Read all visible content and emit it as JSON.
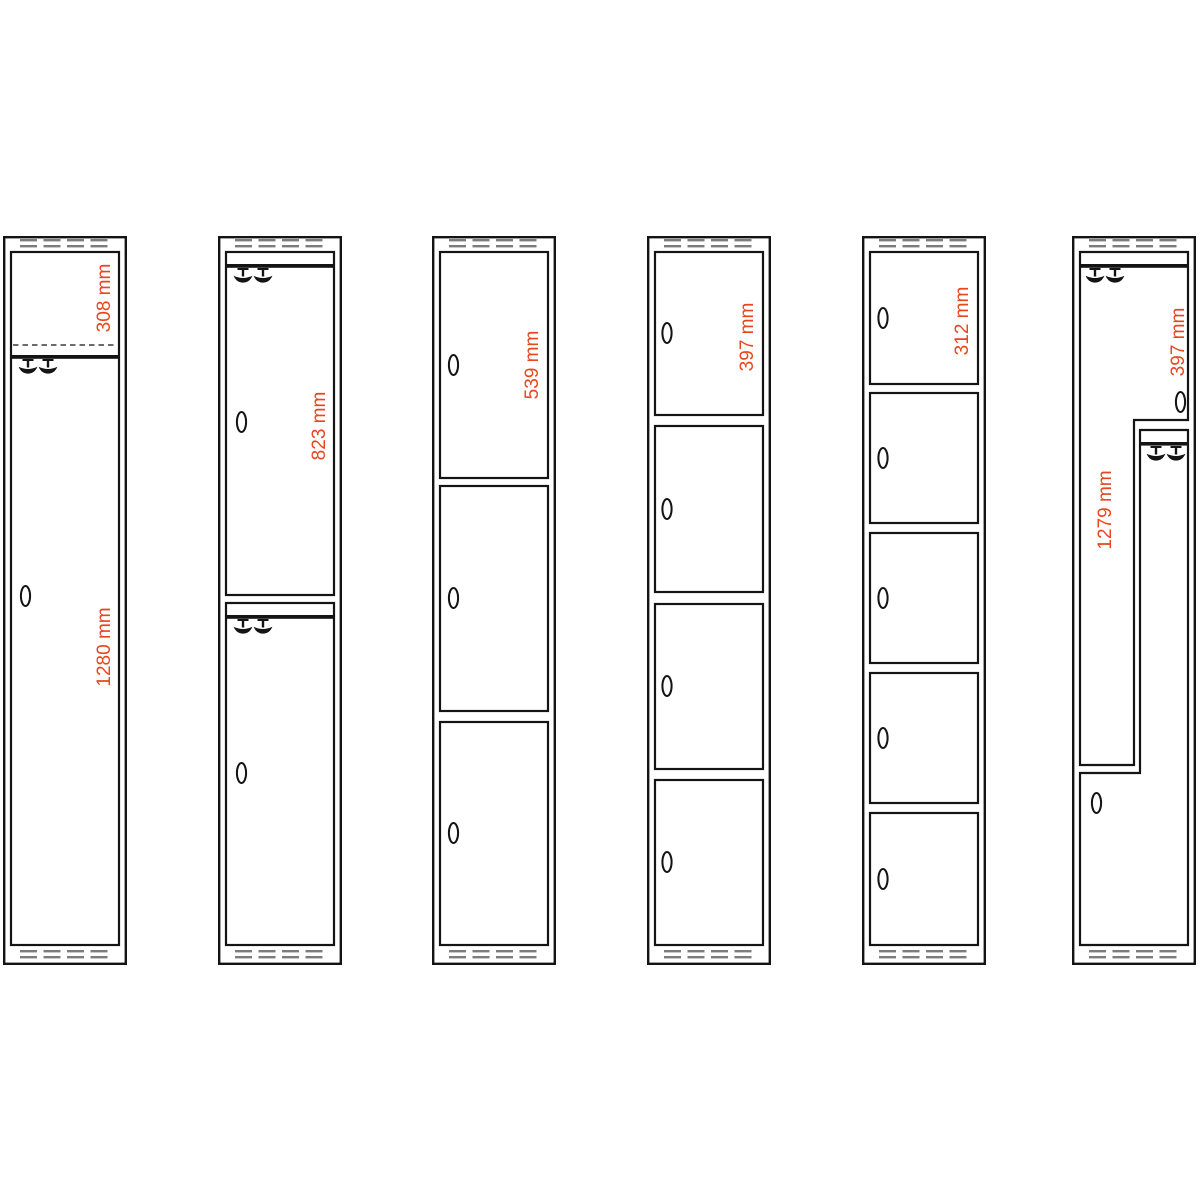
{
  "colors": {
    "dimension_label": "#e8461d",
    "outline": "#141414",
    "vent_slots": "#7c7c7c",
    "background": "#ffffff"
  },
  "lockers": [
    {
      "compartments": 1,
      "features": [
        "top-shelf-dashed",
        "coat-hooks",
        "handle"
      ],
      "dimensions": [
        "308 mm",
        "1280 mm"
      ]
    },
    {
      "compartments": 2,
      "features": [
        "coat-hooks",
        "handles"
      ],
      "dimensions": [
        "823 mm"
      ]
    },
    {
      "compartments": 3,
      "features": [
        "handles"
      ],
      "dimensions": [
        "539 mm"
      ]
    },
    {
      "compartments": 4,
      "features": [
        "handles"
      ],
      "dimensions": [
        "397 mm"
      ]
    },
    {
      "compartments": 5,
      "features": [
        "handles"
      ],
      "dimensions": [
        "312 mm"
      ]
    },
    {
      "compartments": 2,
      "features": [
        "z-doors",
        "coat-hooks",
        "handles"
      ],
      "dimensions": [
        "397 mm",
        "1279 mm"
      ]
    }
  ]
}
